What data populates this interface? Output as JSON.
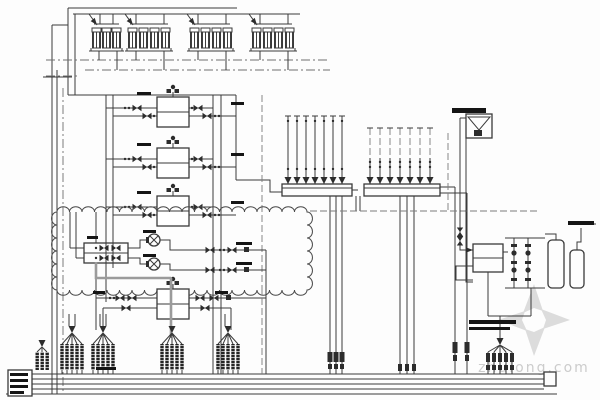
{
  "diagram": {
    "type": "HVAC chilled / condenser water system schematic (CAD line drawing)",
    "equipment": {
      "cooling_tower_groups": 4,
      "cooling_tower_cells_per_group": [
        3,
        4,
        4,
        4
      ],
      "chillers": 4,
      "circulation_pumps": 2,
      "plate_heat_exchanger": 1,
      "distribution_manifolds": 2,
      "manifold_risers_per_manifold": [
        7,
        7
      ],
      "expansion_tank": 1,
      "treatment_tanks": 2,
      "filter_columns": 2,
      "insulated_riser_bundles": 5,
      "bottom_main_pipes": 5
    },
    "revision_cloud": true,
    "annotation_labels_legible": false
  },
  "watermark": {
    "text": "zhulong.com",
    "logo": "pinwheel-icon",
    "text_color": "#cccccc",
    "logo_color": "#dcdcdc"
  },
  "colors": {
    "background": "#fdfdfd",
    "linework": "#3a3a3a",
    "dashed_lines": "#7c7c7c",
    "highlight_pipe": "#9b9b9b",
    "revision_cloud": "#4a4a4a"
  }
}
